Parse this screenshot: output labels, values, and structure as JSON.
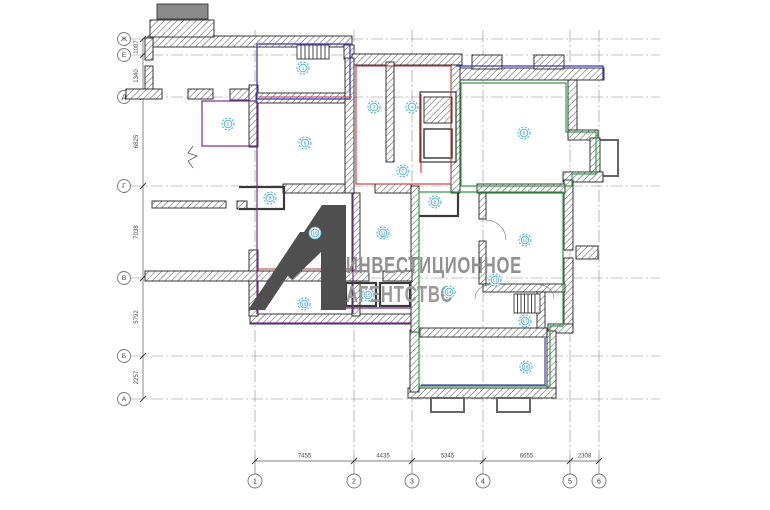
{
  "watermark": {
    "line1": "ИНВЕСТИЦИОННОЕ",
    "line2": "АГЕНТСТВО",
    "logo": "A1-logo"
  },
  "axes": {
    "rows": [
      {
        "label": "Ж",
        "y": 39
      },
      {
        "label": "Е",
        "y": 55
      },
      {
        "label": "Д",
        "y": 97
      },
      {
        "label": "Г",
        "y": 186
      },
      {
        "label": "В",
        "y": 278
      },
      {
        "label": "Б",
        "y": 356
      },
      {
        "label": "А",
        "y": 399
      }
    ],
    "cols": [
      {
        "label": "1",
        "x": 255
      },
      {
        "label": "2",
        "x": 354
      },
      {
        "label": "3",
        "x": 412
      },
      {
        "label": "4",
        "x": 483
      },
      {
        "label": "5",
        "x": 570
      },
      {
        "label": "6",
        "x": 599
      }
    ]
  },
  "dimensions": {
    "left": [
      {
        "value": "1007",
        "from": "Ж",
        "to": "Е"
      },
      {
        "value": "1340",
        "from": "Е",
        "to": "Д"
      },
      {
        "value": "6825",
        "from": "Д",
        "to": "Г"
      },
      {
        "value": "7038",
        "from": "Г",
        "to": "В"
      },
      {
        "value": "5792",
        "from": "В",
        "to": "Б"
      },
      {
        "value": "2257",
        "from": "Б",
        "to": "А"
      }
    ],
    "bottom": [
      {
        "value": "7455",
        "from": "1",
        "to": "2"
      },
      {
        "value": "4435",
        "from": "2",
        "to": "3"
      },
      {
        "value": "5345",
        "from": "3",
        "to": "4"
      },
      {
        "value": "6655",
        "from": "4",
        "to": "5"
      },
      {
        "value": "2308",
        "from": "5",
        "to": "6"
      }
    ]
  },
  "room_markers": [
    {
      "label": "1",
      "x": 303,
      "y": 68
    },
    {
      "label": "2",
      "x": 228,
      "y": 124
    },
    {
      "label": "3",
      "x": 374,
      "y": 107
    },
    {
      "label": "4",
      "x": 412,
      "y": 107
    },
    {
      "label": "5",
      "x": 524,
      "y": 133
    },
    {
      "label": "6",
      "x": 305,
      "y": 143
    },
    {
      "label": "7",
      "x": 403,
      "y": 171
    },
    {
      "label": "8",
      "x": 270,
      "y": 198
    },
    {
      "label": "9",
      "x": 435,
      "y": 202
    },
    {
      "label": "10",
      "x": 315,
      "y": 233
    },
    {
      "label": "11",
      "x": 383,
      "y": 233
    },
    {
      "label": "12",
      "x": 525,
      "y": 240
    },
    {
      "label": "13",
      "x": 495,
      "y": 280
    },
    {
      "label": "14",
      "x": 449,
      "y": 292
    },
    {
      "label": "15",
      "x": 368,
      "y": 295
    },
    {
      "label": "16",
      "x": 304,
      "y": 304
    },
    {
      "label": "17",
      "x": 525,
      "y": 321
    },
    {
      "label": "18",
      "x": 526,
      "y": 367
    }
  ],
  "colors": {
    "wall_line": "#222222",
    "grid_line": "#8a8a8a",
    "dim_text": "#4a4a4a",
    "red_zone": "#c23636",
    "green_zone": "#2f9e44",
    "blue_zone": "#3b3bb3",
    "purple_zone": "#7b2d8e",
    "marker_ring": "#45aede",
    "marker_text": "#1879b5",
    "watermark_logo": "#4f4f4f",
    "watermark_text": "#909090"
  }
}
